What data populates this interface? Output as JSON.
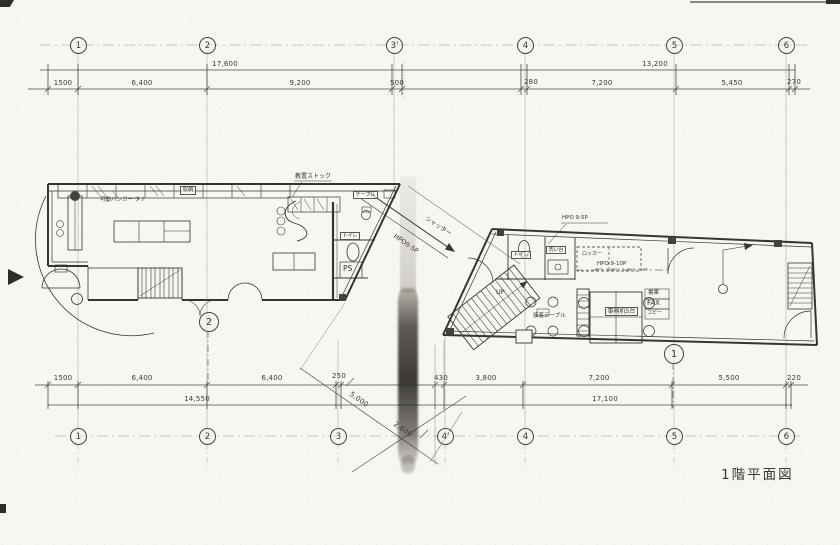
{
  "title": "1階平面図",
  "grid": {
    "top": [
      "1",
      "2",
      "3'",
      "4",
      "5",
      "6"
    ],
    "bottom": [
      "1",
      "2",
      "3",
      "4'",
      "4",
      "5",
      "6"
    ]
  },
  "dims": {
    "top_total_left": "17,600",
    "top_total_right": "13,200",
    "top_seg": [
      "1500",
      "6,400",
      "9,200",
      "500",
      "280",
      "7,200",
      "5,450",
      "270"
    ],
    "bottom_seg": [
      "1500",
      "6,400",
      "6,400",
      "250",
      "430",
      "3,800",
      "7,200",
      "5,500",
      "220"
    ],
    "bottom_total_left": "14,550",
    "bottom_total_right": "17,100",
    "diag_a": "5,000",
    "diag_b": "2,600"
  },
  "left_building": {
    "hanger_shelf": "可動ハンガー タナ",
    "storage": "収納",
    "stock": "教置ストック",
    "table": "テーブル",
    "toilet": "トイレ",
    "pipe_space": "PS",
    "marker": "2"
  },
  "passage": {
    "shutter": "シャッター",
    "shutter_spec": "HPO9-5P"
  },
  "right_building": {
    "spec_top": "HPO 9-5P",
    "spec_mid": "HPO 9-10P",
    "toilet": "トイレ",
    "sink": "洗い台",
    "locker": "ロッカー",
    "stair_up": "UP",
    "reception_table": "接客テーブル",
    "office_desks": "事務机5台",
    "bookshelf": "書庫",
    "fax": "FAX",
    "copier": "コピー",
    "marker": "1"
  }
}
